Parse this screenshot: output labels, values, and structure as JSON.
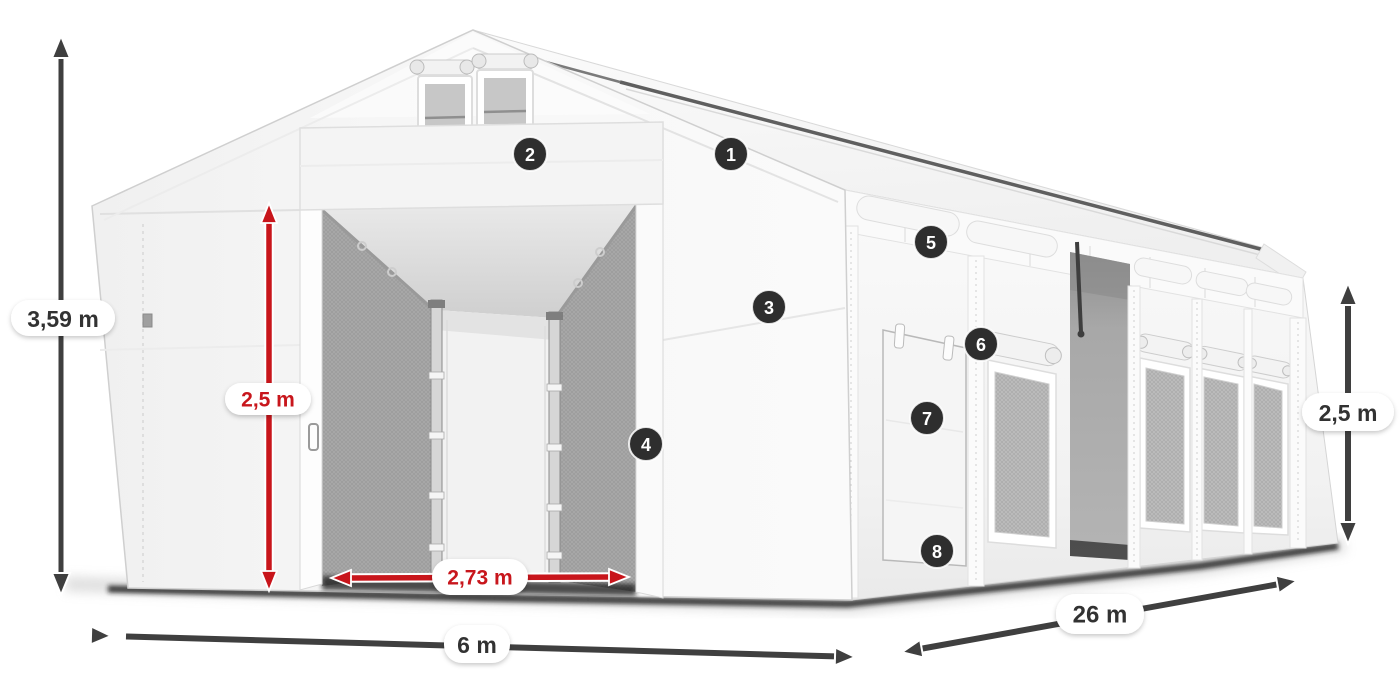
{
  "badges": [
    {
      "number": "1"
    },
    {
      "number": "2"
    },
    {
      "number": "3"
    },
    {
      "number": "4"
    },
    {
      "number": "5"
    },
    {
      "number": "6"
    },
    {
      "number": "7"
    },
    {
      "number": "8"
    }
  ],
  "dims": [
    {
      "name": "total-height",
      "value": "3,59 m"
    },
    {
      "name": "inner-height",
      "value": "2,5 m"
    },
    {
      "name": "door-width",
      "value": "2,73 m"
    },
    {
      "name": "tent-width",
      "value": "6 m"
    },
    {
      "name": "tent-length",
      "value": "26 m"
    },
    {
      "name": "side-height",
      "value": "2,5 m"
    }
  ],
  "colors": {
    "red": "#c8151b",
    "dark_arrow": "#3f3f3f",
    "badge_bg": "#2e2e2e",
    "label_text": "#333333",
    "shadow": "#1c1c1c"
  }
}
